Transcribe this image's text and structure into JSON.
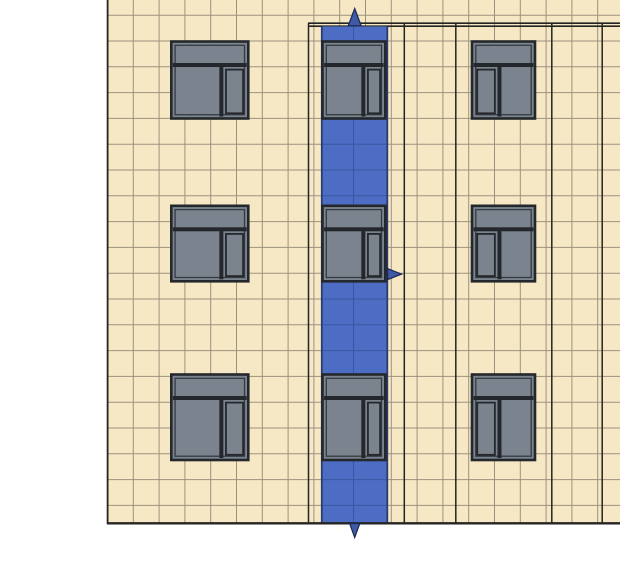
{
  "canvas": {
    "width": 620,
    "height": 577,
    "background": "#ffffff"
  },
  "colors": {
    "wall_fill": "#F6E8C4",
    "grid_line": "#8D8372",
    "major_line": "#232522",
    "window_frame": "#24272B",
    "window_glass": "#7B848E",
    "window_inner_line": "#343A40",
    "band_fill": "#4C6DC3",
    "band_grid": "#3A56A2",
    "band_border": "#2A3B72",
    "arrow_fill": "#3E59A5",
    "arrow_stroke": "#1B2950"
  },
  "wall": {
    "x": 107,
    "y": 0,
    "width": 513,
    "height": 524
  },
  "wall_edges": {
    "left_x": 107.6,
    "left_y1": 0,
    "left_y2": 524,
    "left_width": 1.8,
    "bottom_y": 523.3,
    "bottom_x1": 107,
    "bottom_x2": 620,
    "bottom_width": 2.4
  },
  "grid": {
    "vertical_x": [
      133.3,
      159.1,
      184.9,
      210.7,
      236.5,
      262.3,
      288.1,
      313.9,
      339.7,
      365.5,
      391.3,
      417.1,
      442.9,
      468.7,
      494.5,
      520.3,
      546.1,
      571.9,
      597.7
    ],
    "v_y1": 0,
    "v_y2": 523.3,
    "horizontal_y": [
      15.2,
      41.0,
      66.8,
      92.6,
      118.4,
      144.2,
      170.0,
      195.8,
      221.6,
      247.4,
      273.2,
      299.0,
      324.8,
      350.6,
      376.4,
      402.2,
      428.0,
      453.8,
      479.6,
      505.4
    ],
    "h_x1": 107,
    "h_x2": 620,
    "line_width": 1,
    "opacity": 0.85
  },
  "major_vertical_lines": {
    "x_values": [
      308.5,
      404.3,
      455.8,
      551.8,
      602.2
    ],
    "y1": 23.2,
    "y2": 523.3,
    "width": 1.5
  },
  "top_double_line": {
    "x1": 308,
    "x2": 620,
    "y_values": [
      23.2,
      26.2
    ],
    "width": 1.7
  },
  "selection_band": {
    "name": "selection-band",
    "x": 321.8,
    "width": 65.5,
    "y_top": 26.4,
    "y_bottom": 523.3,
    "inner_vertical_x": [
      353.5
    ],
    "border_width": 1.8
  },
  "window_style": {
    "frame_width": 2.6,
    "inner_inset": 3.8,
    "inner_width": 1.3,
    "transom_height": 21.5,
    "divider_thickness": 4,
    "split_normal": 0.65,
    "split_mirrored": 0.436,
    "casement_inset": 2.6,
    "casement_stroke": 1.8
  },
  "windows": [
    {
      "name": "window-row1-left",
      "x": 171.3,
      "y": 41.5,
      "w": 77.0,
      "h": 77.0,
      "mirrored": false
    },
    {
      "name": "window-row1-center",
      "x": 322.5,
      "y": 41.5,
      "w": 62.8,
      "h": 77.0,
      "mirrored": false
    },
    {
      "name": "window-row1-right",
      "x": 472.0,
      "y": 41.5,
      "w": 63.0,
      "h": 77.0,
      "mirrored": true
    },
    {
      "name": "window-row2-left",
      "x": 171.3,
      "y": 205.8,
      "w": 77.0,
      "h": 75.5,
      "mirrored": false
    },
    {
      "name": "window-row2-center",
      "x": 322.5,
      "y": 205.8,
      "w": 62.8,
      "h": 75.5,
      "mirrored": false
    },
    {
      "name": "window-row2-right",
      "x": 472.0,
      "y": 205.8,
      "w": 63.0,
      "h": 75.5,
      "mirrored": true
    },
    {
      "name": "window-row3-left",
      "x": 171.3,
      "y": 374.5,
      "w": 77.0,
      "h": 85.5,
      "mirrored": false
    },
    {
      "name": "window-row3-center",
      "x": 322.5,
      "y": 374.5,
      "w": 62.8,
      "h": 85.5,
      "mirrored": false
    },
    {
      "name": "window-row3-right",
      "x": 472.0,
      "y": 374.5,
      "w": 63.0,
      "h": 85.5,
      "mirrored": true
    }
  ],
  "arrows": [
    {
      "name": "selection-arrow-up-icon",
      "points": "348.2,25.8 361.2,25.8 354.7,8.5"
    },
    {
      "name": "selection-arrow-down-icon",
      "points": "349.6,523.5 359.8,523.5 354.7,537.5"
    },
    {
      "name": "selection-arrow-right-icon",
      "points": "387.6,268.6 387.6,279.6 401.6,274.1"
    }
  ]
}
